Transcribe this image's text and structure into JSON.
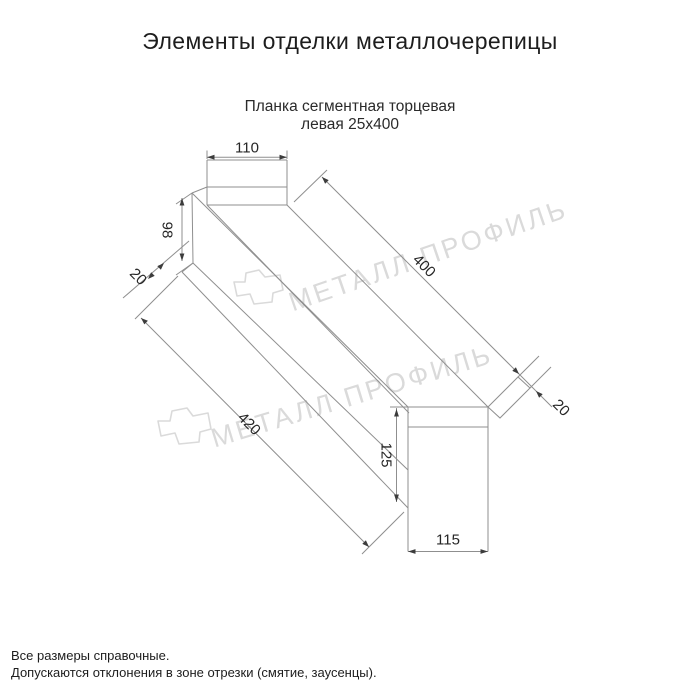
{
  "title": "Элементы отделки металлочерепицы",
  "subtitle_line1": "Планка сегментная торцевая",
  "subtitle_line2": "левая 25х400",
  "dimensions": {
    "top_width": "110",
    "left_height": "98",
    "left_hem": "20",
    "length": "400",
    "bottom_length": "420",
    "right_hem": "20",
    "right_height": "125",
    "right_width": "115"
  },
  "watermark": {
    "text": "МЕТАЛЛ ПРОФИЛЬ"
  },
  "notes": [
    "Все размеры справочные.",
    "Допускаются отклонения в зоне отрезки (смятие, заусенцы)."
  ],
  "colors": {
    "line": "#8f8f8f",
    "arrow": "#3c3c3c",
    "text": "#262626",
    "watermark": "#dadada"
  }
}
